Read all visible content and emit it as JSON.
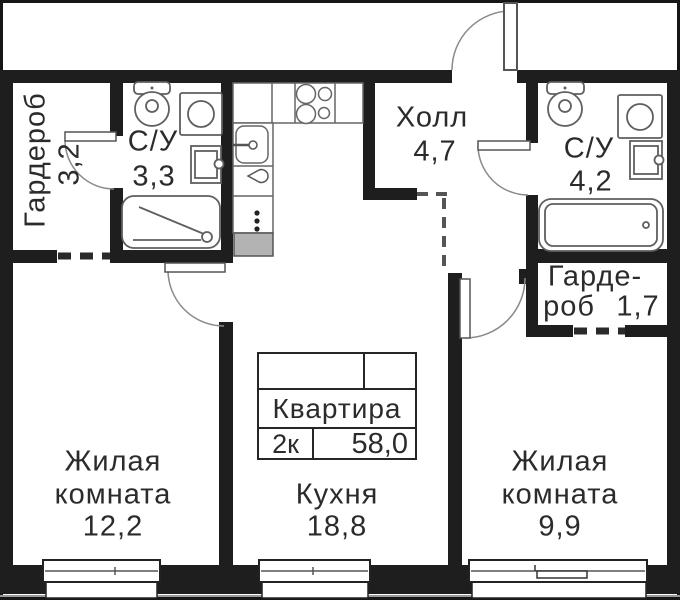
{
  "stamp": {
    "title": "Квартира",
    "type": "2к",
    "area": "58,0"
  },
  "rooms": {
    "wardrobe_left": {
      "name": "Гардероб",
      "area": "3,2"
    },
    "bathroom_left": {
      "name": "С/У",
      "area": "3,3"
    },
    "hall": {
      "name": "Холл",
      "area": "4,7"
    },
    "bathroom_right": {
      "name": "С/У",
      "area": "4,2"
    },
    "wardrobe_right": {
      "name_line1": "Гарде-",
      "name_line2": "роб",
      "area": "1,7"
    },
    "living_room_1": {
      "name_line1": "Жилая",
      "name_line2": "комната",
      "area": "12,2"
    },
    "kitchen": {
      "name": "Кухня",
      "area": "18,8"
    },
    "living_room_2": {
      "name_line1": "Жилая",
      "name_line2": "комната",
      "area": "9,9"
    }
  },
  "colors": {
    "wall": "#1e1e1e",
    "fixture": "#5f5f5f",
    "text": "#2b2b2b"
  }
}
